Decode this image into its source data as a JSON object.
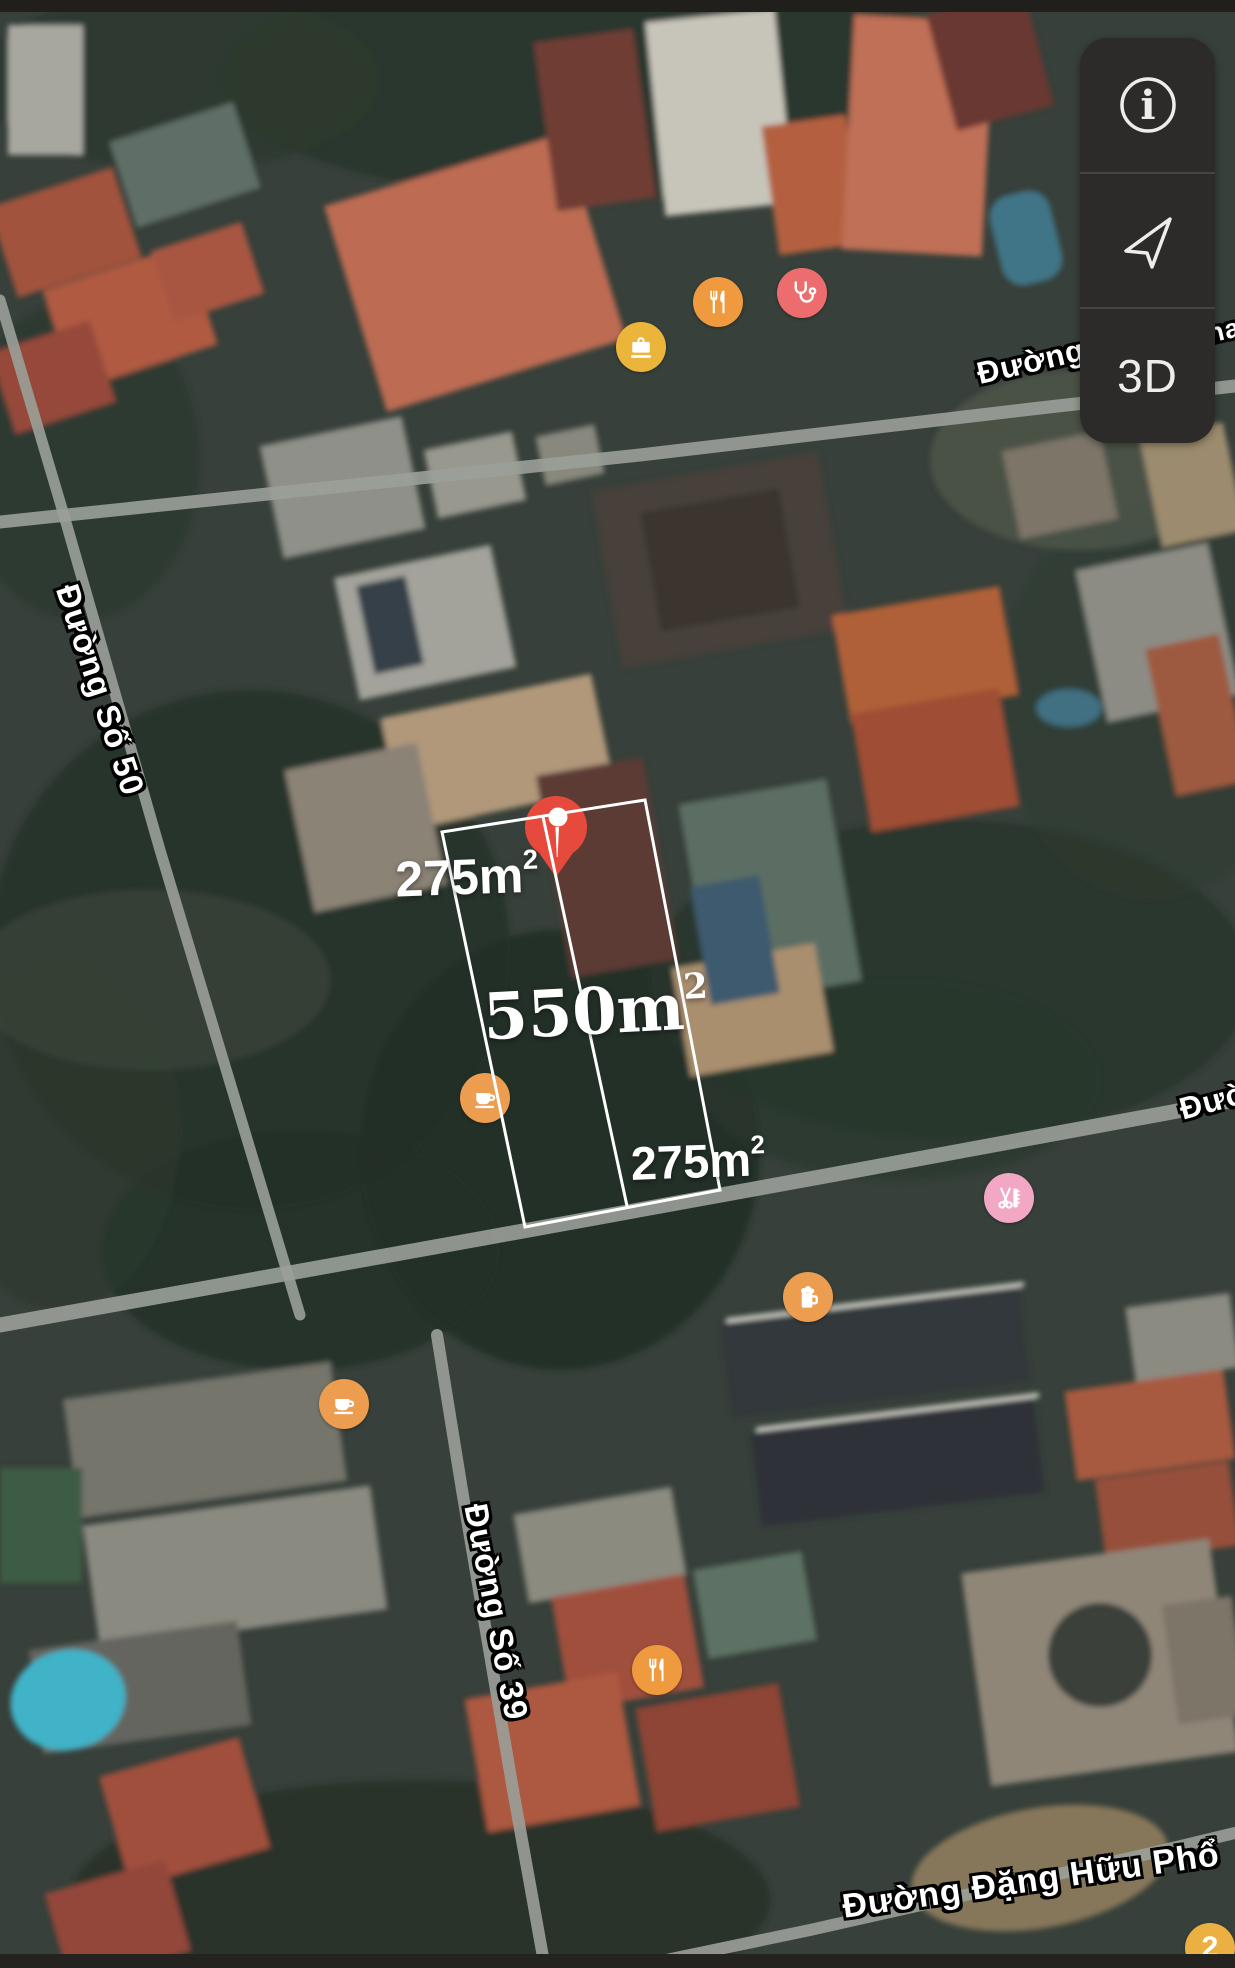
{
  "controls": {
    "items": [
      {
        "id": "info",
        "icon": "info-icon"
      },
      {
        "id": "locate",
        "icon": "location-arrow-icon"
      },
      {
        "id": "mode-3d",
        "label": "3D"
      }
    ]
  },
  "streets": [
    {
      "id": "duong-top",
      "text": "Đường",
      "x": 1031,
      "y": 362,
      "rotate": -13,
      "size": 31
    },
    {
      "id": "duong-top-fragment",
      "text": "na",
      "x": 1224,
      "y": 331,
      "rotate": -13,
      "size": 27
    },
    {
      "id": "duong-so-50",
      "text": "Đường Số 50",
      "x": 100,
      "y": 690,
      "rotate": 72,
      "size": 33
    },
    {
      "id": "duong-right-fragment",
      "text": "Đườ",
      "x": 1214,
      "y": 1101,
      "rotate": -15,
      "size": 31
    },
    {
      "id": "duong-so-39",
      "text": "Đường Số 39",
      "x": 496,
      "y": 1612,
      "rotate": 79,
      "size": 33
    },
    {
      "id": "duong-dang-huu-pho",
      "text": "Đường Đặng Hữu Phổ",
      "x": 1031,
      "y": 1881,
      "rotate": -8,
      "size": 34
    }
  ],
  "parcel": {
    "outline_color": "#ffffff",
    "corners": [
      [
        442,
        832
      ],
      [
        645,
        800
      ],
      [
        720,
        1190
      ],
      [
        525,
        1227
      ]
    ],
    "divider": [
      [
        543,
        817
      ],
      [
        627,
        1206
      ]
    ],
    "areas": [
      {
        "id": "area-top",
        "base": "275m",
        "sup": "2",
        "x": 467,
        "y": 877,
        "font": "sans",
        "size": 50,
        "rotate": -2
      },
      {
        "id": "area-total",
        "base": "550m",
        "sup": "2",
        "x": 596,
        "y": 1012,
        "font": "serif",
        "size": 64,
        "rotate": -3
      },
      {
        "id": "area-bottom",
        "base": "275m",
        "sup": "2",
        "x": 698,
        "y": 1161,
        "font": "sans",
        "size": 47,
        "rotate": -2
      }
    ]
  },
  "pin": {
    "x": 556,
    "y": 827,
    "color": "#E64A3C"
  },
  "pois": [
    {
      "id": "restaurant-1",
      "glyph": "fork-knife",
      "x": 718,
      "y": 302,
      "color": "#EF9A3E"
    },
    {
      "id": "medical-1",
      "glyph": "stethoscope",
      "x": 802,
      "y": 293,
      "color": "#ED6D6F"
    },
    {
      "id": "shopping-1",
      "glyph": "briefcase",
      "x": 641,
      "y": 347,
      "color": "#EBB53B"
    },
    {
      "id": "cafe-1",
      "glyph": "coffee-cup",
      "x": 485,
      "y": 1098,
      "color": "#EC9D50"
    },
    {
      "id": "bar-1",
      "glyph": "beer-mug",
      "x": 808,
      "y": 1297,
      "color": "#EC9D50"
    },
    {
      "id": "salon-1",
      "glyph": "scissors-comb",
      "x": 1009,
      "y": 1198,
      "color": "#F2A8C5"
    },
    {
      "id": "cafe-2",
      "glyph": "coffee-cup",
      "x": 344,
      "y": 1404,
      "color": "#EC9D50"
    },
    {
      "id": "restaurant-2",
      "glyph": "fork-knife",
      "x": 657,
      "y": 1670,
      "color": "#EF9A3E"
    },
    {
      "id": "poi-cluster",
      "glyph": "count",
      "label": "2",
      "x": 1210,
      "y": 1948,
      "color": "#EBB042"
    }
  ],
  "roads": [
    {
      "id": "top-road",
      "width": 13,
      "points": [
        [
          0,
          522
        ],
        [
          640,
          455
        ],
        [
          1040,
          408
        ],
        [
          1235,
          386
        ]
      ]
    },
    {
      "id": "duong-so-50-road",
      "width": 11,
      "points": [
        [
          0,
          300
        ],
        [
          63,
          512
        ],
        [
          160,
          850
        ],
        [
          300,
          1315
        ]
      ]
    },
    {
      "id": "middle-road",
      "width": 15,
      "points": [
        [
          0,
          1325
        ],
        [
          490,
          1237
        ],
        [
          820,
          1177
        ],
        [
          1172,
          1112
        ],
        [
          1235,
          1100
        ]
      ]
    },
    {
      "id": "duong-so-39-road",
      "width": 12,
      "points": [
        [
          437,
          1335
        ],
        [
          462,
          1490
        ],
        [
          513,
          1790
        ],
        [
          545,
          1968
        ]
      ]
    },
    {
      "id": "dang-huu-pho-road",
      "width": 12,
      "points": [
        [
          628,
          1968
        ],
        [
          810,
          1930
        ],
        [
          1143,
          1855
        ],
        [
          1235,
          1833
        ]
      ]
    }
  ],
  "colors": {
    "road": "#9aa099",
    "panel_bg": "#2c2b29",
    "panel_text": "#ededed",
    "pin_red": "#E64A3C",
    "outline_white": "#ffffff",
    "poi_orange": "#EF9A3E",
    "poi_gold": "#EBB53B",
    "poi_pink": "#ED6D6F",
    "poi_salon_pink": "#F2A8C5"
  }
}
